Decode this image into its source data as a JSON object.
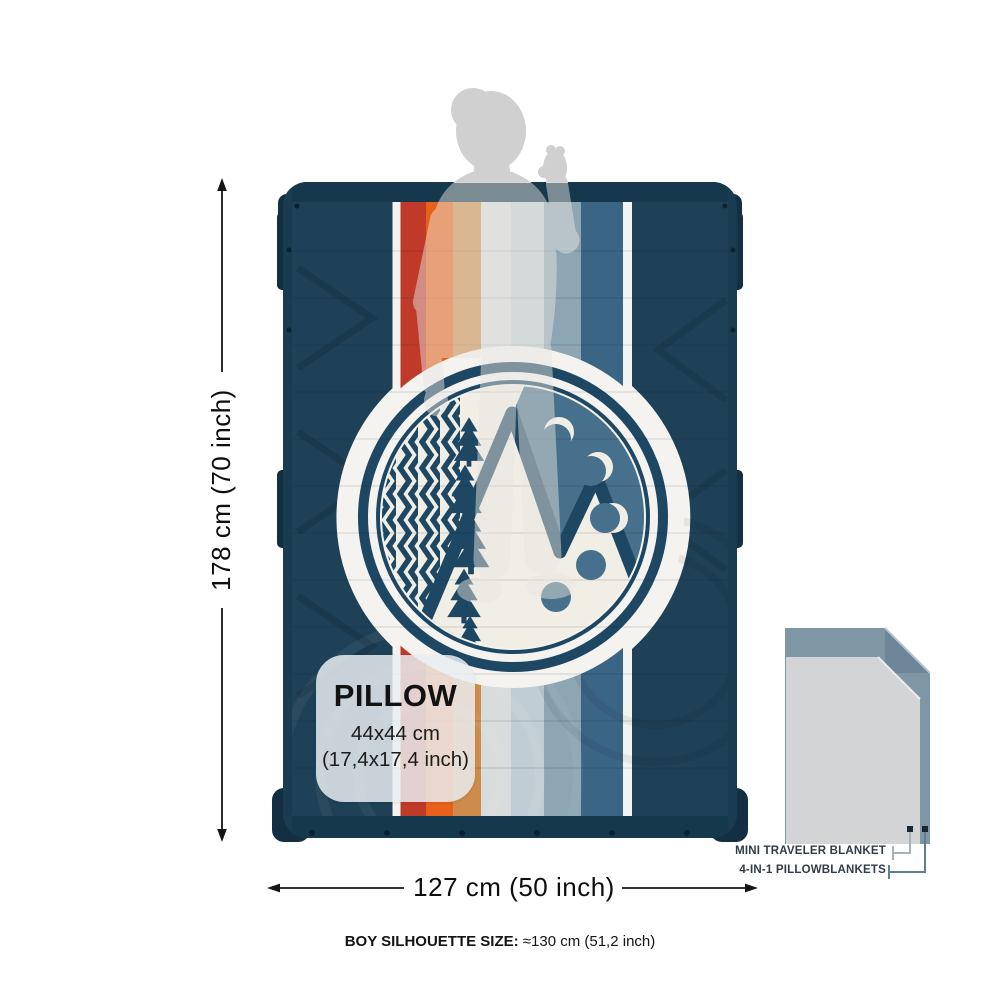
{
  "dimensions": {
    "height_label": "178 cm  (70 inch)",
    "width_label": "127 cm  (50 inch)"
  },
  "pillow_box": {
    "title": "PILLOW",
    "size_cm": "44x44 cm",
    "size_inch": "(17,4x17,4 inch)"
  },
  "legend": {
    "items": [
      {
        "label": "MINI TRAVELER BLANKET"
      },
      {
        "label": "4-IN-1 PILLOWBLANKETS"
      }
    ]
  },
  "footer": {
    "label": "BOY SILHOUETTE SIZE:",
    "value": " ≈130 cm (51,2 inch)"
  },
  "blanket": {
    "base_color": "#1e4157",
    "edge_color": "#16384d",
    "emblem_navy": "#1d4763",
    "emblem_cream": "#f1eee6",
    "emblem_steel": "#47708c",
    "stripe_area": {
      "y": 202,
      "height": 614
    },
    "stripes": [
      {
        "name": "white-left",
        "x": 393,
        "width": 7,
        "color": "#f4f3f0",
        "shape": "wrap"
      },
      {
        "name": "red",
        "x": 400,
        "width": 26,
        "color": "#c03a2a",
        "shape": "straight"
      },
      {
        "name": "orange",
        "x": 426,
        "width": 27,
        "color": "#e8611a",
        "shape": "straight"
      },
      {
        "name": "ochre",
        "x": 453,
        "width": 28,
        "color": "#cd8c4c",
        "shape": "straight"
      },
      {
        "name": "pale-gray",
        "x": 481,
        "width": 30,
        "color": "#d9dcdd",
        "shape": "straight"
      },
      {
        "name": "pale-blue",
        "x": 511,
        "width": 33,
        "color": "#c1cdd4",
        "shape": "straight"
      },
      {
        "name": "light-steel",
        "x": 544,
        "width": 37,
        "color": "#8ca6b4",
        "shape": "straight"
      },
      {
        "name": "dark-steel",
        "x": 581,
        "width": 42,
        "color": "#3b6585",
        "shape": "straight"
      },
      {
        "name": "white-right",
        "x": 623,
        "width": 9,
        "color": "#f4f3f0",
        "shape": "wrap"
      }
    ]
  },
  "mini_diagram": {
    "back_color": "#7f96a4",
    "front_color": "#d2d4d5",
    "silhouette_gray": "#d0d0d0"
  }
}
